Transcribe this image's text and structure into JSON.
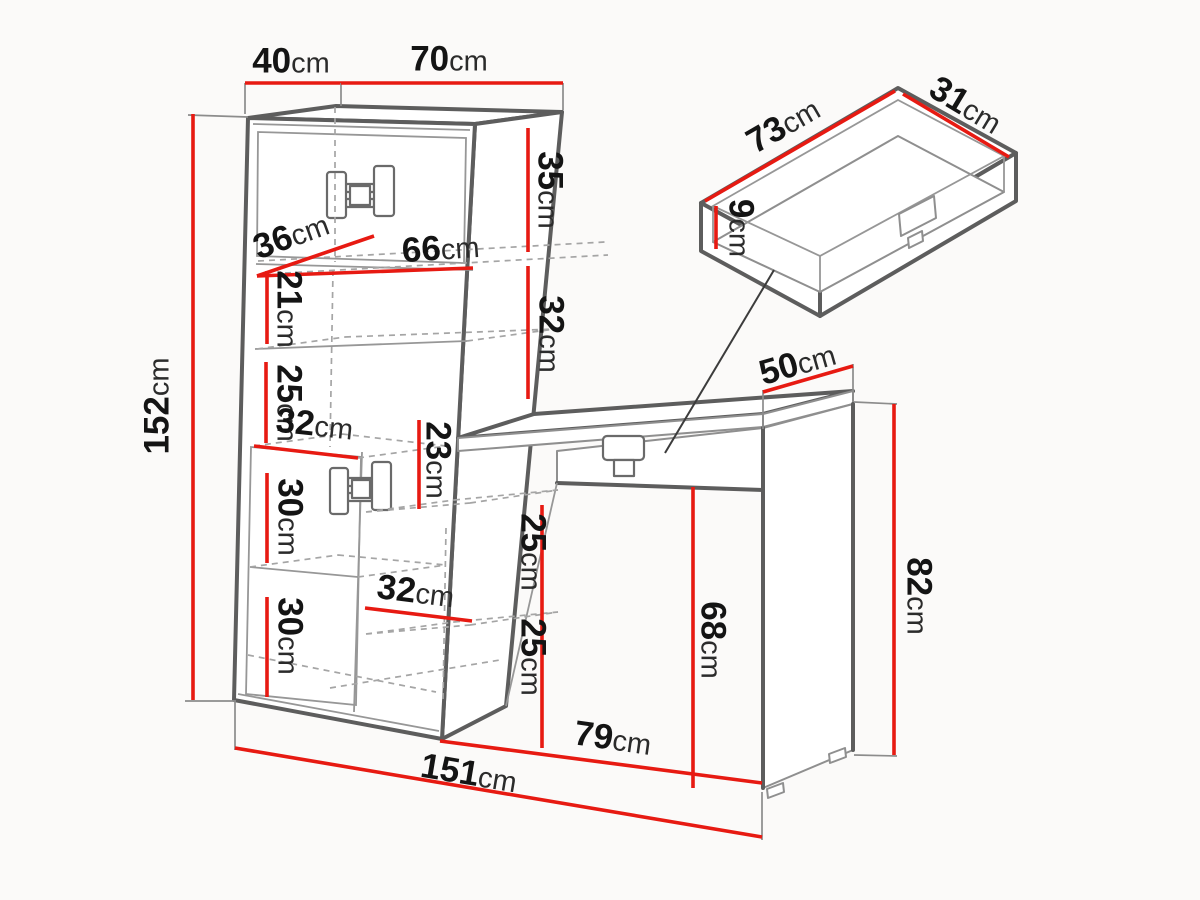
{
  "diagram": {
    "kind": "furniture-dimension-drawing",
    "unit": "cm"
  },
  "colors": {
    "background": "#fbfaf9",
    "dimension_red": "#e71a12",
    "edge_gray": "#5d5d5d",
    "thin_gray": "#979797",
    "dash_gray": "#a5a5a5",
    "text_black": "#141414"
  },
  "dimensions": [
    {
      "id": "cabinet-depth-top",
      "value": "40",
      "unit": "cm",
      "lx": 291,
      "ly": 67,
      "rot": 0,
      "line": [
        245,
        83,
        341,
        83
      ],
      "ext": [
        [
          245,
          83,
          245,
          114
        ]
      ]
    },
    {
      "id": "cabinet-width-top",
      "value": "70",
      "unit": "cm",
      "lx": 449,
      "ly": 65,
      "rot": 0,
      "line": [
        341,
        83,
        563,
        83
      ],
      "ext": [
        [
          341,
          83,
          341,
          106
        ],
        [
          563,
          83,
          563,
          110
        ]
      ]
    },
    {
      "id": "cabinet-height",
      "value": "152",
      "unit": "cm",
      "lx": 163,
      "ly": 406,
      "rot": -90,
      "line": [
        193,
        114,
        193,
        700
      ],
      "ext": [
        [
          188,
          115,
          248,
          117
        ],
        [
          185,
          701,
          236,
          701
        ]
      ]
    },
    {
      "id": "upper-section-35",
      "value": "35",
      "unit": "cm",
      "lx": 544,
      "ly": 190,
      "rot": 90,
      "line": [
        528,
        128,
        528,
        252
      ],
      "ext": []
    },
    {
      "id": "upper-section-32",
      "value": "32",
      "unit": "cm",
      "lx": 545,
      "ly": 334,
      "rot": 90,
      "line": [
        528,
        266,
        528,
        399
      ],
      "ext": []
    },
    {
      "id": "shelf-depth-36",
      "value": "36",
      "unit": "cm",
      "lx": 293,
      "ly": 241,
      "rot": -20,
      "line": [
        257,
        276,
        374,
        236
      ],
      "ext": []
    },
    {
      "id": "shelf-width-66",
      "value": "66",
      "unit": "cm",
      "lx": 441,
      "ly": 254,
      "rot": -4,
      "line": [
        257,
        276,
        473,
        268
      ],
      "ext": []
    },
    {
      "id": "section-21",
      "value": "21",
      "unit": "cm",
      "lx": 283,
      "ly": 309,
      "rot": 90,
      "line": [
        267,
        271,
        267,
        344
      ],
      "ext": []
    },
    {
      "id": "section-25-left",
      "value": "25",
      "unit": "cm",
      "lx": 283,
      "ly": 403,
      "rot": 90,
      "line": [
        266,
        362,
        266,
        443
      ],
      "ext": []
    },
    {
      "id": "shelf-width-32-upper",
      "value": "32",
      "unit": "cm",
      "lx": 314,
      "ly": 430,
      "rot": 6,
      "line": [
        254,
        446,
        358,
        458
      ],
      "ext": []
    },
    {
      "id": "section-30-a",
      "value": "30",
      "unit": "cm",
      "lx": 284,
      "ly": 517,
      "rot": 90,
      "line": [
        267,
        473,
        267,
        563
      ],
      "ext": []
    },
    {
      "id": "section-30-b",
      "value": "30",
      "unit": "cm",
      "lx": 284,
      "ly": 636,
      "rot": 90,
      "line": [
        267,
        597,
        267,
        697
      ],
      "ext": []
    },
    {
      "id": "section-23",
      "value": "23",
      "unit": "cm",
      "lx": 432,
      "ly": 460,
      "rot": 90,
      "line": [
        419,
        420,
        419,
        509
      ],
      "ext": []
    },
    {
      "id": "shelf-width-32-lower",
      "value": "32",
      "unit": "cm",
      "lx": 415,
      "ly": 597,
      "rot": 7,
      "line": [
        365,
        608,
        472,
        621
      ],
      "ext": []
    },
    {
      "id": "section-25-mid-a",
      "value": "25",
      "unit": "cm",
      "lx": 527,
      "ly": 552,
      "rot": 90,
      "line": [
        542,
        505,
        542,
        631
      ],
      "ext": []
    },
    {
      "id": "section-25-mid-b",
      "value": "25",
      "unit": "cm",
      "lx": 527,
      "ly": 657,
      "rot": 90,
      "line": [
        542,
        631,
        542,
        748
      ],
      "ext": []
    },
    {
      "id": "desk-depth-50",
      "value": "50",
      "unit": "cm",
      "lx": 799,
      "ly": 369,
      "rot": -16,
      "line": [
        763,
        392,
        853,
        366
      ],
      "ext": [
        [
          763,
          390,
          763,
          429
        ],
        [
          853,
          364,
          853,
          401
        ]
      ]
    },
    {
      "id": "desk-height-82",
      "value": "82",
      "unit": "cm",
      "lx": 913,
      "ly": 596,
      "rot": 90,
      "line": [
        894,
        404,
        894,
        755
      ],
      "ext": [
        [
          854,
          402,
          897,
          404
        ],
        [
          854,
          755,
          897,
          756
        ]
      ]
    },
    {
      "id": "desk-clearance-68",
      "value": "68",
      "unit": "cm",
      "lx": 707,
      "ly": 640,
      "rot": 90,
      "line": [
        693,
        487,
        693,
        788
      ],
      "ext": []
    },
    {
      "id": "desk-width-79",
      "value": "79",
      "unit": "cm",
      "lx": 612,
      "ly": 744,
      "rot": 8,
      "line": [
        440,
        741,
        762,
        783
      ],
      "ext": []
    },
    {
      "id": "total-width-151",
      "value": "151",
      "unit": "cm",
      "lx": 468,
      "ly": 779,
      "rot": 9.5,
      "line": [
        235,
        748,
        762,
        837
      ],
      "ext": [
        [
          235,
          702,
          235,
          750
        ],
        [
          762,
          792,
          762,
          840
        ]
      ]
    },
    {
      "id": "drawer-length-73",
      "value": "73",
      "unit": "cm",
      "lx": 786,
      "ly": 130,
      "rot": -30,
      "line": [
        705,
        201,
        895,
        91
      ],
      "ext": []
    },
    {
      "id": "drawer-width-31",
      "value": "31",
      "unit": "cm",
      "lx": 963,
      "ly": 110,
      "rot": 31,
      "line": [
        903,
        94,
        1009,
        157
      ],
      "ext": []
    },
    {
      "id": "drawer-height-9",
      "value": "9",
      "unit": "cm",
      "lx": 735,
      "ly": 228,
      "rot": 90,
      "line": [
        716,
        206,
        716,
        249
      ],
      "ext": []
    }
  ]
}
